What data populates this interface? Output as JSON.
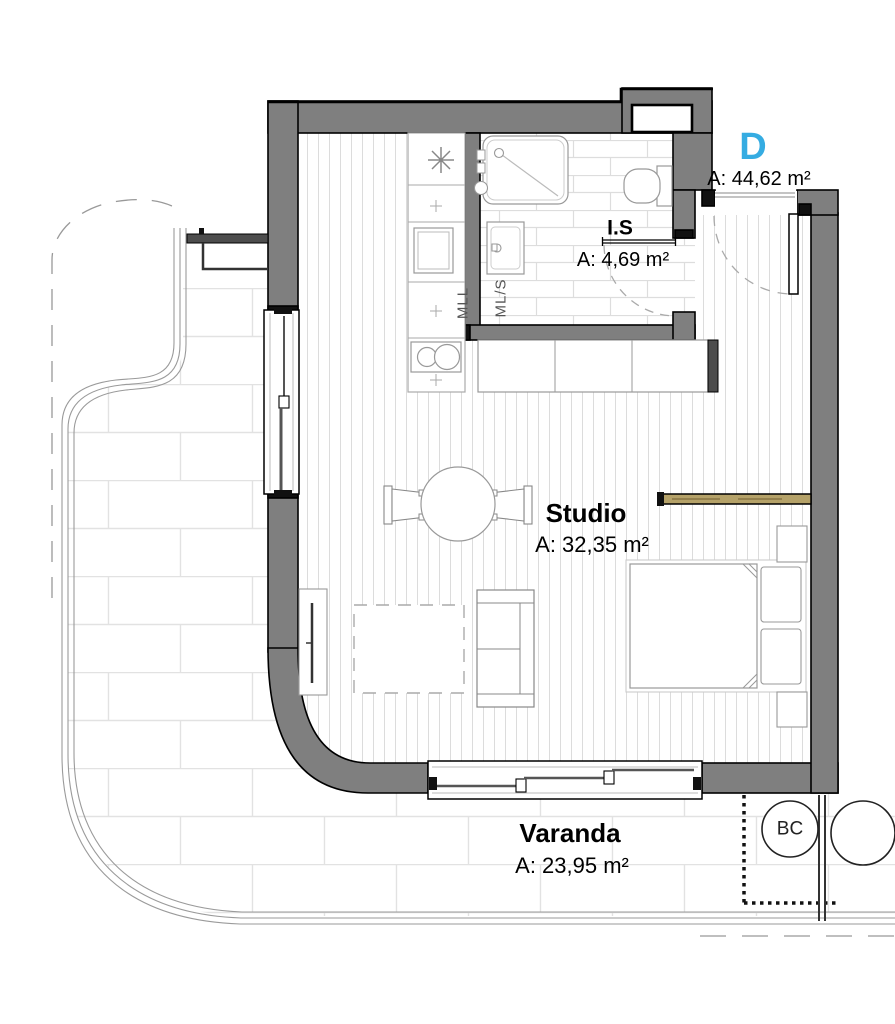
{
  "unit": {
    "label": "D",
    "area": "A: 44,62 m²"
  },
  "rooms": {
    "bathroom": {
      "label": "I.S",
      "area": "A: 4,69 m²"
    },
    "studio": {
      "label": "Studio",
      "area": "A: 32,35 m²"
    },
    "balcony": {
      "label": "Varanda",
      "area": "A: 23,95 m²"
    }
  },
  "appliances": {
    "dishwasher_label": "MLL",
    "washer_label": "ML/S"
  },
  "annotations": {
    "bc_label": "BC"
  },
  "colors": {
    "unit_accent": "#35ACE2",
    "wall_fill": "#7F7F7F",
    "wall_dark": "#4D4D4D",
    "outline": "#000000",
    "wood_floor_line": "#DCDCDC",
    "bath_tile_line": "#DDDDDD",
    "paving_line": "#E2E2E2",
    "partition_wood": "#B5A269"
  }
}
